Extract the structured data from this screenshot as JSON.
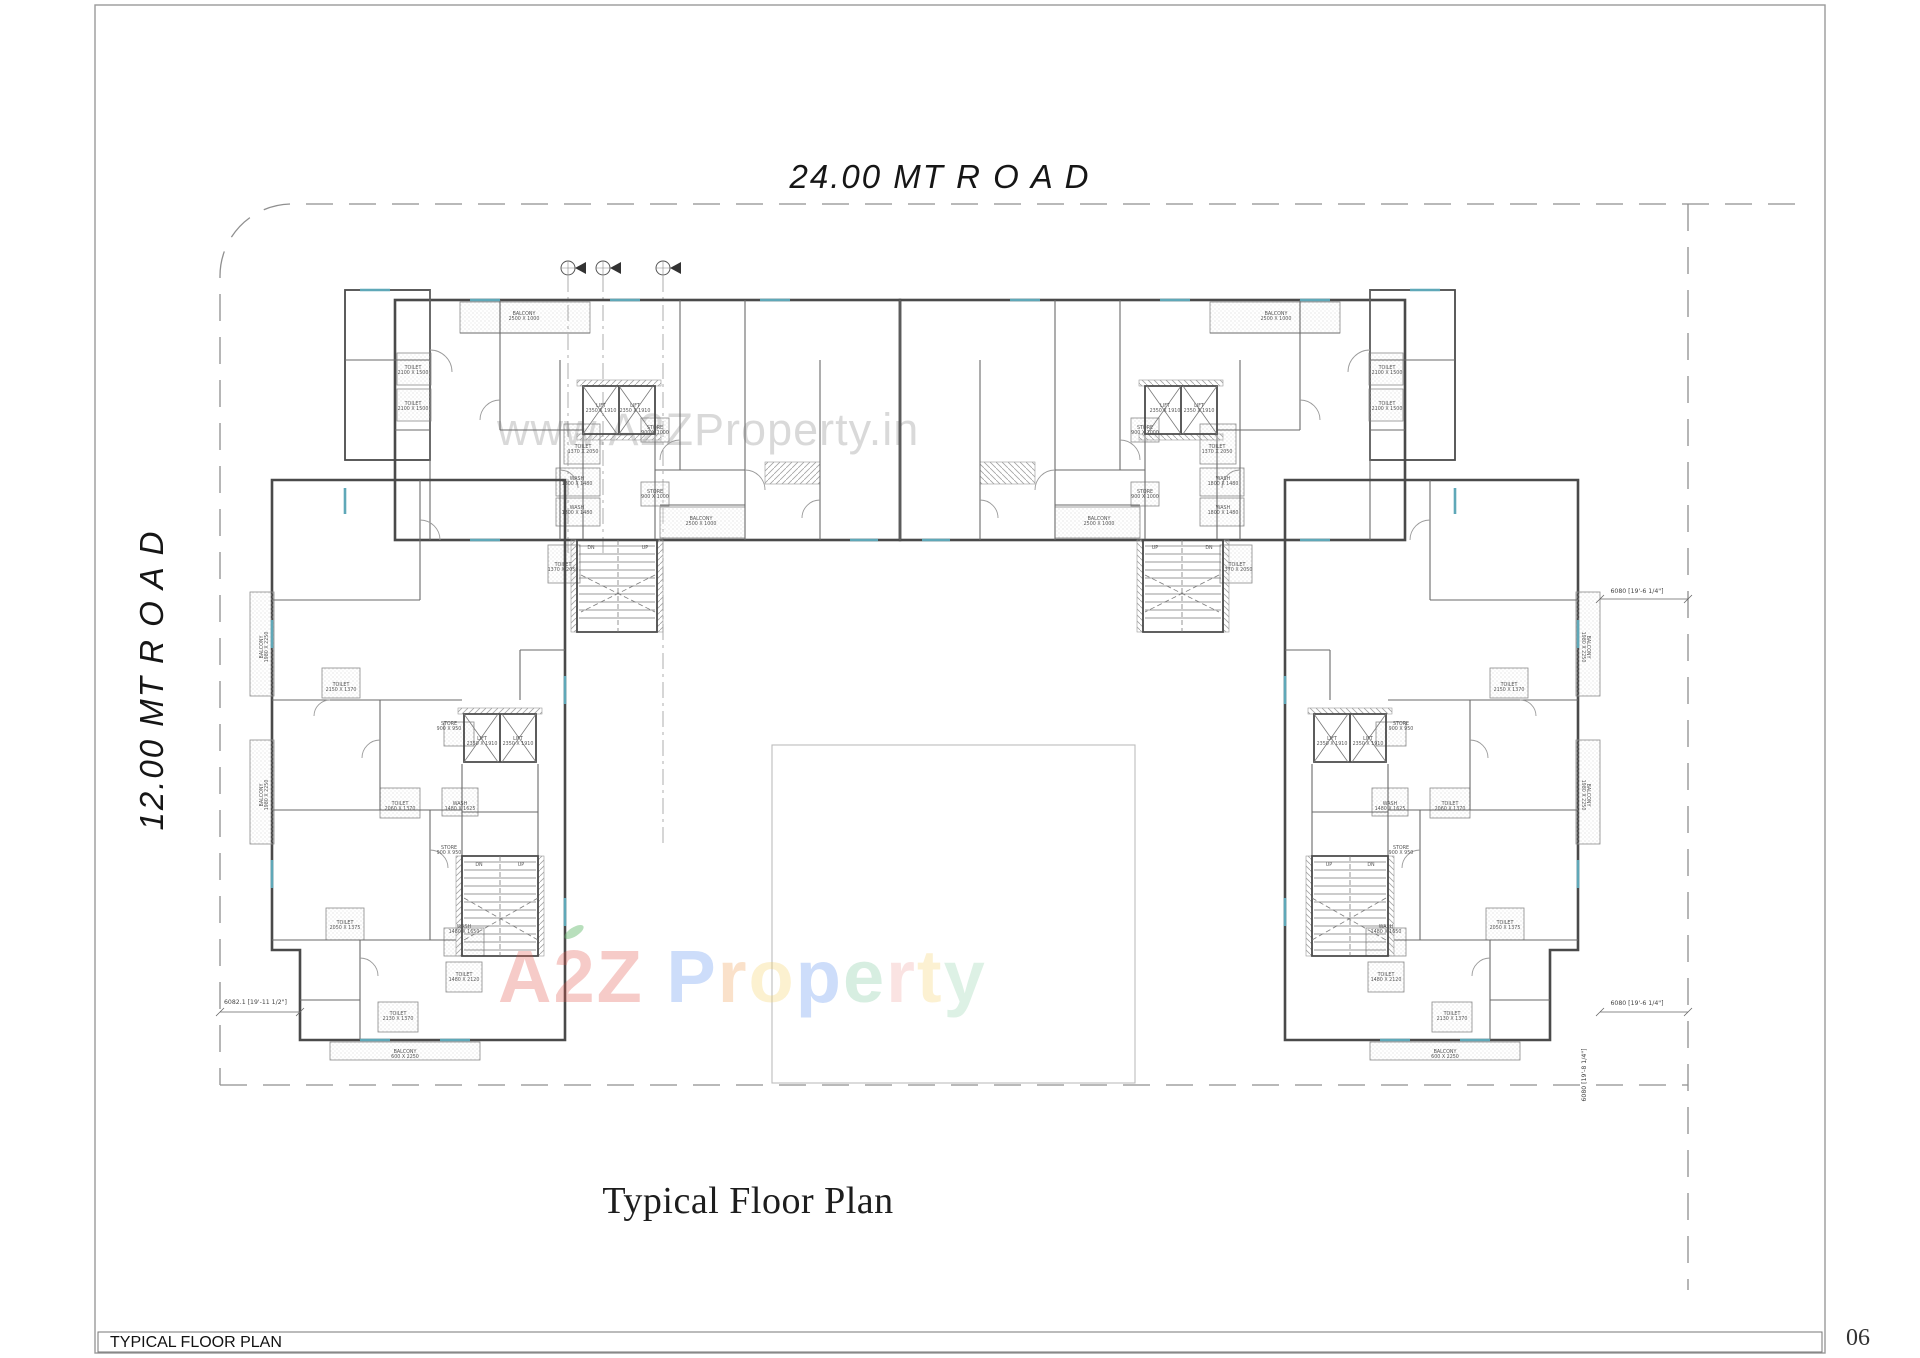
{
  "page": {
    "caption": "Typical Floor Plan",
    "footer_label": "TYPICAL FLOOR PLAN",
    "number": "06"
  },
  "roads": {
    "top": "24.00 MT  R O A D",
    "left": "12.00 MT  R O A D"
  },
  "watermarks": {
    "gray_text": "www.A2ZProperty.in",
    "colored_letters": [
      {
        "ch": "A",
        "color": "#e25248"
      },
      {
        "ch": "2",
        "color": "#e25248"
      },
      {
        "ch": "Z",
        "color": "#e25248"
      },
      {
        "ch": " ",
        "color": "#000000"
      },
      {
        "ch": "P",
        "color": "#5b8def"
      },
      {
        "ch": "r",
        "color": "#f09a4e"
      },
      {
        "ch": "o",
        "color": "#f6cf63"
      },
      {
        "ch": "p",
        "color": "#5b8def"
      },
      {
        "ch": "e",
        "color": "#7cc79a"
      },
      {
        "ch": "r",
        "color": "#efa3a0"
      },
      {
        "ch": "t",
        "color": "#f6d06b"
      },
      {
        "ch": "y",
        "color": "#8fd0a8"
      }
    ]
  },
  "dimensions": {
    "right_upper": "6080 [19'-6 1/4\"]",
    "right_lower": "6080 [19'-6 1/4\"]",
    "right_vertical": "6080 [19'-8 1/4\"]",
    "left_lower": "6082.1 [19'-11 1/2\"]"
  },
  "plan": {
    "rooms": [
      {
        "n": "TOILET",
        "d": "2100 X 1500",
        "x": 413,
        "y": 369
      },
      {
        "n": "TOILET",
        "d": "2100 X 1500",
        "x": 413,
        "y": 405
      },
      {
        "n": "BALCONY",
        "d": "2500 X 1000",
        "x": 524,
        "y": 315
      },
      {
        "n": "TOILET",
        "d": "1370 X 2050",
        "x": 583,
        "y": 448
      },
      {
        "n": "WASH",
        "d": "1800 X 1480",
        "x": 577,
        "y": 480
      },
      {
        "n": "WASH",
        "d": "1800 X 1480",
        "x": 577,
        "y": 509
      },
      {
        "n": "STORE",
        "d": "900 X 1000",
        "x": 655,
        "y": 429
      },
      {
        "n": "STORE",
        "d": "900 X 1000",
        "x": 655,
        "y": 493
      },
      {
        "n": "LIFT",
        "d": "2350 X 1910",
        "x": 601,
        "y": 407
      },
      {
        "n": "LIFT",
        "d": "2350 X 1910",
        "x": 635,
        "y": 407
      },
      {
        "n": "TOILET",
        "d": "1370 X 2050",
        "x": 563,
        "y": 566
      },
      {
        "n": "BALCONY",
        "d": "2500 X 1000",
        "x": 701,
        "y": 520
      },
      {
        "n": "DN",
        "d": "",
        "x": 591,
        "y": 549
      },
      {
        "n": "UP",
        "d": "",
        "x": 645,
        "y": 549
      },
      {
        "n": "TOILET",
        "d": "2100 X 1500",
        "x": 1387,
        "y": 369
      },
      {
        "n": "TOILET",
        "d": "2100 X 1500",
        "x": 1387,
        "y": 405
      },
      {
        "n": "BALCONY",
        "d": "2500 X 1000",
        "x": 1276,
        "y": 315
      },
      {
        "n": "TOILET",
        "d": "1370 X 2050",
        "x": 1217,
        "y": 448
      },
      {
        "n": "WASH",
        "d": "1800 X 1480",
        "x": 1223,
        "y": 480
      },
      {
        "n": "WASH",
        "d": "1800 X 1480",
        "x": 1223,
        "y": 509
      },
      {
        "n": "STORE",
        "d": "900 X 1000",
        "x": 1145,
        "y": 429
      },
      {
        "n": "STORE",
        "d": "900 X 1000",
        "x": 1145,
        "y": 493
      },
      {
        "n": "LIFT",
        "d": "2350 X 1910",
        "x": 1199,
        "y": 407
      },
      {
        "n": "LIFT",
        "d": "2350 X 1910",
        "x": 1165,
        "y": 407
      },
      {
        "n": "TOILET",
        "d": "1370 X 2050",
        "x": 1237,
        "y": 566
      },
      {
        "n": "BALCONY",
        "d": "2500 X 1000",
        "x": 1099,
        "y": 520
      },
      {
        "n": "DN",
        "d": "",
        "x": 1209,
        "y": 549
      },
      {
        "n": "UP",
        "d": "",
        "x": 1155,
        "y": 549
      },
      {
        "n": "BALCONY",
        "d": "1980 X 2250",
        "x": 263,
        "y": 647,
        "r": -90
      },
      {
        "n": "BALCONY",
        "d": "1980 X 2250",
        "x": 263,
        "y": 795,
        "r": -90
      },
      {
        "n": "TOILET",
        "d": "2150 X 1370",
        "x": 341,
        "y": 686
      },
      {
        "n": "TOILET",
        "d": "2060 X 1370",
        "x": 400,
        "y": 805
      },
      {
        "n": "WASH",
        "d": "1480 X 1625",
        "x": 460,
        "y": 805
      },
      {
        "n": "LIFT",
        "d": "2350 X 1910",
        "x": 482,
        "y": 740
      },
      {
        "n": "LIFT",
        "d": "2350 X 1910",
        "x": 518,
        "y": 740
      },
      {
        "n": "STORE",
        "d": "900 X 950",
        "x": 449,
        "y": 725
      },
      {
        "n": "STORE",
        "d": "900 X 950",
        "x": 449,
        "y": 849
      },
      {
        "n": "TOILET",
        "d": "2050 X 1375",
        "x": 345,
        "y": 924
      },
      {
        "n": "WASH",
        "d": "1480 X 1650",
        "x": 464,
        "y": 928
      },
      {
        "n": "TOILET",
        "d": "1480 X 2120",
        "x": 464,
        "y": 976
      },
      {
        "n": "TOILET",
        "d": "2130 X 1370",
        "x": 398,
        "y": 1015
      },
      {
        "n": "DN",
        "d": "",
        "x": 479,
        "y": 866
      },
      {
        "n": "UP",
        "d": "",
        "x": 521,
        "y": 866
      },
      {
        "n": "BALCONY",
        "d": "600 X 2250",
        "x": 405,
        "y": 1053
      },
      {
        "n": "BALCONY",
        "d": "1980 X 2250",
        "x": 1587,
        "y": 647,
        "r": 90
      },
      {
        "n": "BALCONY",
        "d": "1980 X 2250",
        "x": 1587,
        "y": 795,
        "r": 90
      },
      {
        "n": "TOILET",
        "d": "2150 X 1370",
        "x": 1509,
        "y": 686
      },
      {
        "n": "TOILET",
        "d": "2060 X 1370",
        "x": 1450,
        "y": 805
      },
      {
        "n": "WASH",
        "d": "1480 X 1625",
        "x": 1390,
        "y": 805
      },
      {
        "n": "LIFT",
        "d": "2350 X 1910",
        "x": 1368,
        "y": 740
      },
      {
        "n": "LIFT",
        "d": "2350 X 1910",
        "x": 1332,
        "y": 740
      },
      {
        "n": "STORE",
        "d": "900 X 950",
        "x": 1401,
        "y": 725
      },
      {
        "n": "STORE",
        "d": "900 X 950",
        "x": 1401,
        "y": 849
      },
      {
        "n": "TOILET",
        "d": "2050 X 1375",
        "x": 1505,
        "y": 924
      },
      {
        "n": "WASH",
        "d": "1480 X 1650",
        "x": 1386,
        "y": 928
      },
      {
        "n": "TOILET",
        "d": "1480 X 2120",
        "x": 1386,
        "y": 976
      },
      {
        "n": "TOILET",
        "d": "2130 X 1370",
        "x": 1452,
        "y": 1015
      },
      {
        "n": "DN",
        "d": "",
        "x": 1371,
        "y": 866
      },
      {
        "n": "UP",
        "d": "",
        "x": 1329,
        "y": 866
      },
      {
        "n": "BALCONY",
        "d": "600 X 2250",
        "x": 1445,
        "y": 1053
      }
    ]
  }
}
